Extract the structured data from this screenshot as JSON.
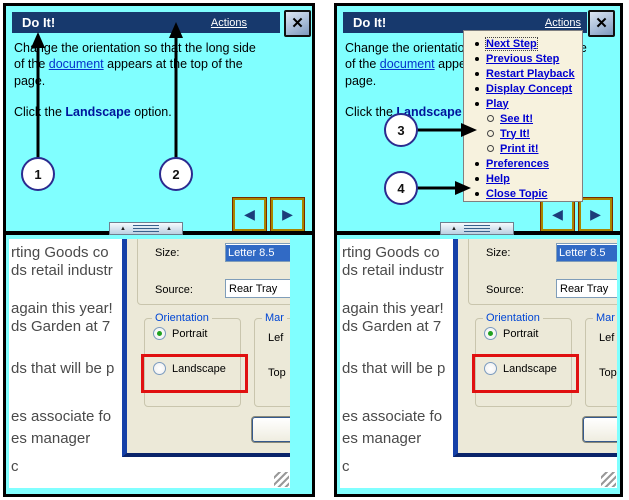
{
  "window": {
    "title": "Do It!",
    "actions_label": "Actions",
    "close_glyph": "✕"
  },
  "help": {
    "p1_before": "Change the orientation so that the long side of the ",
    "p1_link": "document",
    "p1_after": " appears at the top of the page.",
    "p2_before": "Click the ",
    "p2_bold": "Landscape",
    "p2_after": " option."
  },
  "callouts": {
    "c1": "1",
    "c2": "2",
    "c3": "3",
    "c4": "4"
  },
  "nav": {
    "prev_glyph": "◀",
    "next_glyph": "▶"
  },
  "menu": {
    "items": [
      {
        "label": "Next Step",
        "focused": true
      },
      {
        "label": "Previous Step"
      },
      {
        "label": "Restart Playback"
      },
      {
        "label": "Display Concept"
      },
      {
        "label": "Play"
      },
      {
        "label": "See It!",
        "sub": true
      },
      {
        "label": "Try It!",
        "sub": true
      },
      {
        "label": "Print it!",
        "sub": true
      },
      {
        "label": "Preferences"
      },
      {
        "label": "Help"
      },
      {
        "label": "Close Topic"
      }
    ]
  },
  "app": {
    "doc_lines": [
      "rting Goods co",
      "ds retail industr",
      "again this year!",
      "ds Garden at 7",
      "ds that will be p",
      "es associate fo",
      "es manager",
      "c"
    ],
    "dialog": {
      "size_label": "Size:",
      "size_value": "Letter 8.5",
      "source_label": "Source:",
      "source_value": "Rear Tray",
      "orientation_label": "Orientation",
      "portrait_label": "Portrait",
      "landscape_label": "Landscape",
      "margins_label": "Mar",
      "left_label": "Lef",
      "top_label": "Top"
    }
  },
  "colors": {
    "cyan_bg": "#80FFFF",
    "titlebar_navy": "#17396D",
    "menu_bg": "#F7F2DE",
    "link_blue": "#0000D0",
    "highlight_red": "#E01010",
    "dialog_bg": "#ECE9D8",
    "selection_blue": "#316AC5"
  }
}
